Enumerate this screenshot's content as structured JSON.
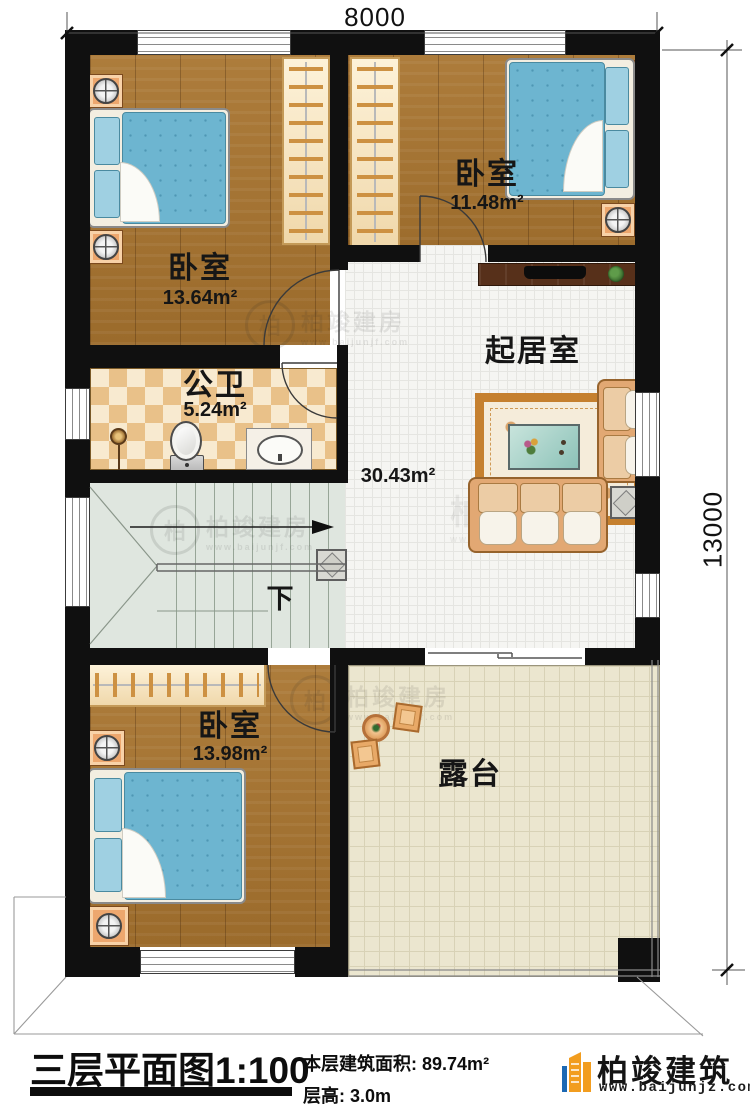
{
  "dimensions": {
    "width_label": "8000",
    "height_label": "13000"
  },
  "rooms": {
    "bedroom_top_left": {
      "name": "卧室",
      "area": "13.64m²"
    },
    "bedroom_top_right": {
      "name": "卧室",
      "area": "11.48m²"
    },
    "bathroom": {
      "name": "公卫",
      "area": "5.24m²"
    },
    "living_room": {
      "name": "起居室",
      "area": "30.43m²"
    },
    "bedroom_bottom": {
      "name": "卧室",
      "area": "13.98m²"
    },
    "terrace": {
      "name": "露台"
    },
    "stairs": {
      "direction_label": "下"
    }
  },
  "title_block": {
    "plan_title": "三层平面图",
    "plan_scale": "1:100",
    "floor_area_label": "本层建筑面积:",
    "floor_area_value": "89.74m²",
    "floor_height_label": "层高:",
    "floor_height_value": "3.0m"
  },
  "branding": {
    "company": "柏竣建筑",
    "website": "www.baijunjz.com"
  },
  "watermark": {
    "monogram": "柏",
    "name": "柏竣建房",
    "site": "www.baijunjf.com"
  },
  "colors": {
    "wall": "#101010",
    "wood_floor": "#a8742f",
    "tile_floor": "#f5f5f2",
    "terrace_floor": "#ebe6cf",
    "bath_tile_a": "#e9c189",
    "bath_tile_b": "#f8ead0",
    "stair_floor": "#dfe6df",
    "bed_blue": "#6db5d0",
    "sofa_tan": "#e2a873",
    "nightstand_orange": "#eda76e",
    "brand_blue": "#1c69b4",
    "brand_orange": "#f29d1f"
  }
}
